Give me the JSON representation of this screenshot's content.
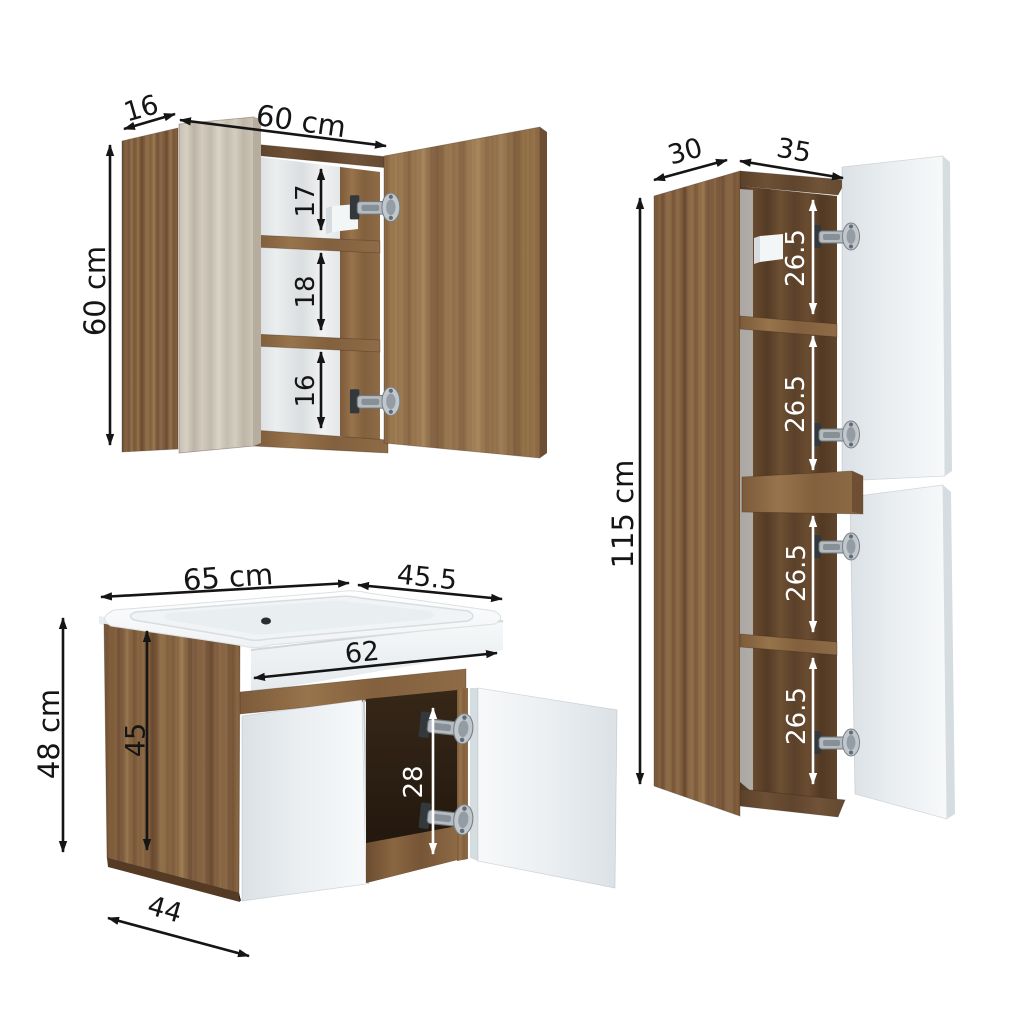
{
  "diagram_title": "Bathroom furniture set dimension diagram",
  "units": "cm",
  "colors": {
    "background": "#ffffff",
    "dimension_line": "#151515",
    "dimension_line_inner": "#ffffff",
    "wood": "#8a6745",
    "wood_dark": "#5e432b",
    "wood_light_door": "#cdc6b9",
    "door_white": "#eef1f3",
    "sink_white": "#fafcfd"
  },
  "mirror_cabinet": {
    "name": "mirror cabinet",
    "depth_label": "16",
    "width_label": "60 cm",
    "height_label": "60 cm",
    "sections": [
      "17",
      "18",
      "16"
    ]
  },
  "tall_cabinet": {
    "name": "tall side cabinet",
    "depth_label": "30",
    "width_label": "35",
    "height_label": "115 cm",
    "sections": [
      "26.5",
      "26.5",
      "26.5",
      "26.5"
    ]
  },
  "vanity": {
    "name": "sink vanity unit",
    "top_width_label": "65 cm",
    "top_depth_label": "45.5",
    "inner_width_label": "62",
    "height_label": "48 cm",
    "body_height_label": "45",
    "opening_height_label": "28",
    "bottom_depth_label": "44"
  }
}
